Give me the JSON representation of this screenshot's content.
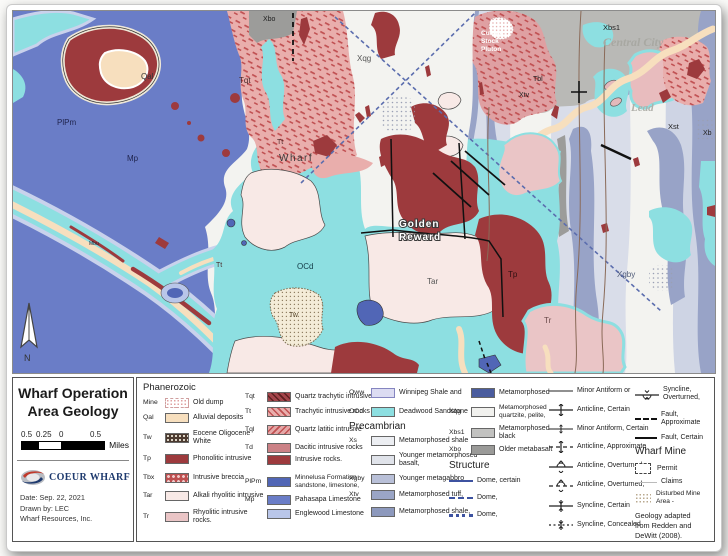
{
  "map": {
    "labels": {
      "qal": "Qal",
      "plpm": "PlPm",
      "mp": "Mp",
      "mbu": "Mbu",
      "tqt": "Tqt",
      "xbo": "Xbo",
      "xqg": "Xqg",
      "tt1": "Tt",
      "tt2": "Tt",
      "wharf": "Wharf",
      "ocd": "OCd",
      "tw": "Tw",
      "golden_reward_line1": "Golden",
      "golden_reward_line2": "Reward",
      "tar": "Tar",
      "tp": "Tp",
      "tr": "Tr",
      "xgby": "Xgby",
      "cutting_line1": "Cutting",
      "cutting_line2": "Stock",
      "cutting_line3": "Pluton",
      "tbl": "Tbl",
      "xtv": "Xtv",
      "xbs1": "Xbs1",
      "central_city": "Central City",
      "lead": "Lead",
      "xst": "Xst",
      "xb": "Xb",
      "north": "N"
    }
  },
  "title_block": {
    "title_line1": "Wharf Operation",
    "title_line2": "Area Geology",
    "scale_ticks": [
      "0.5",
      "0.25",
      "0",
      "0.5"
    ],
    "scale_unit": "Miles",
    "logo_text": "COEUR WHARF",
    "date": "Date: Sep. 22, 2021",
    "drawn_by": "Drawn by: LEC",
    "company": "Wharf Resources, Inc."
  },
  "legend": {
    "phanerozoic_header": "Phanerozoic",
    "precambrian_header": "Precambrian",
    "structure_header": "Structure",
    "wharf_mine_header": "Wharf Mine",
    "col1": [
      {
        "code": "Mine",
        "label": "Old dump"
      },
      {
        "code": "Qal",
        "label": "Alluvial deposits"
      },
      {
        "code": "Tw",
        "label": "Eocene Oligocene White"
      },
      {
        "code": "Tp",
        "label": "Phonolitic intrusive"
      },
      {
        "code": "Tbx",
        "label": "Intrusive breccia"
      },
      {
        "code": "Tar",
        "label": "Alkali rhyolitic intrusive"
      },
      {
        "code": "Tr",
        "label": "Rhyolitic intrusive rocks."
      }
    ],
    "col2": [
      {
        "code": "Tqt",
        "label": "Quartz trachytic intrusive"
      },
      {
        "code": "Tt",
        "label": "Trachytic intrusive rocks"
      },
      {
        "code": "Tql",
        "label": "Quartz latitic intrusive"
      },
      {
        "code": "Td",
        "label": "Dacitic intrusive rocks"
      },
      {
        "code": "",
        "label": "Intrusive rocks."
      },
      {
        "code": "PlPm",
        "label": "Minnelusa Formation sandstone, limestone,"
      },
      {
        "code": "Mp",
        "label": "Pahasapa Limestone"
      },
      {
        "code": "",
        "label": "Englewood Limestone"
      }
    ],
    "col3": [
      {
        "code": "Oww",
        "label": "Winnipeg Shale and"
      },
      {
        "code": "OCd",
        "label": "Deadwood Sandstone"
      },
      {
        "code": "Xs",
        "label": "Metamorphosed shale"
      },
      {
        "code": "",
        "label": "Younger metamorphosed basalt,"
      },
      {
        "code": "Xgby",
        "label": "Younger metagabbro"
      },
      {
        "code": "Xtv",
        "label": "Metamorphosed tuff,"
      },
      {
        "code": "",
        "label": "Metamorphosed shale,"
      }
    ],
    "col4": [
      {
        "code": "",
        "label": "Metamorphosed"
      },
      {
        "code": "Xqg",
        "label": "Metamorphosed quartzite, pelite,"
      },
      {
        "code": "Xbs1",
        "label": "Metamorphosed black"
      },
      {
        "code": "Xbo",
        "label": "Older metabasalt"
      },
      {
        "code": "",
        "label": "Dome, certain"
      },
      {
        "code": "",
        "label": "Dome,"
      },
      {
        "code": "",
        "label": "Dome,"
      }
    ],
    "col5": [
      "Minor Antiform or",
      "Anticline, Certain",
      "Minor Antiform, Certain",
      "Anticline, Approximate",
      "Anticline, Overturned,",
      "Anticline, Overturned,",
      "Syncline, Certain",
      "Syncline, Concealed"
    ],
    "col6": [
      "Syncline, Overturned,",
      "Fault, Approximate",
      "Fault, Certain"
    ],
    "wharf_mine_items": [
      "Permit",
      "Claims",
      "Disturbed Mine Area -"
    ],
    "credit": "Geology adapted from Redden and DeWitt (2008)."
  },
  "colors": {
    "qal": "#f7dfbe",
    "tw": "#4c3a30",
    "tp": "#9d3a3d",
    "tbx": "#bd4f50",
    "tar": "#f8e9e6",
    "tr": "#eac5c6",
    "tqt": "#a4454b",
    "tt": "#e9aeac",
    "tql": "#e4a7a7",
    "td": "#cb8186",
    "plpm": "#5166b6",
    "mp": "#6a7dc7",
    "englewood": "#b9c6e9",
    "oww": "#dcdcf2",
    "ocd": "#8ddfe1",
    "xs": "#eceef2",
    "xgby": "#b9c0d8",
    "xtv": "#9aa5c6",
    "metamorphosed": "#4a5c9e",
    "xqg": "#f1f1ee",
    "xbs1": "#c2c2c0",
    "xbo": "#9a9a98",
    "structure_line": "#3d52a0",
    "fault": "#111111"
  }
}
